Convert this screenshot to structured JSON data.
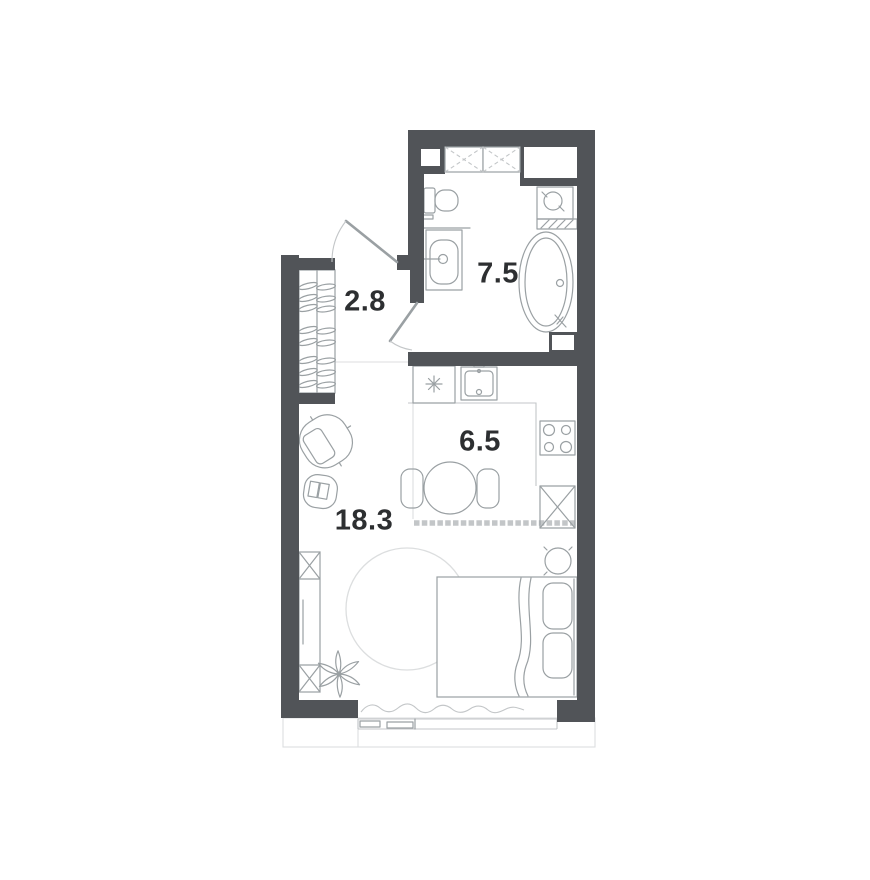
{
  "floor_plan": {
    "rooms": [
      {
        "name": "hallway",
        "area_label": "2.8"
      },
      {
        "name": "bathroom",
        "area_label": "7.5"
      },
      {
        "name": "kitchen",
        "area_label": "6.5"
      },
      {
        "name": "living-room",
        "area_label": "18.3"
      }
    ],
    "fixtures": [
      "entrance-door",
      "hallway-wardrobe-with-hangers",
      "ventilation-shaft",
      "wall-niche",
      "toilet",
      "washbasin",
      "washing-machine",
      "bathtub",
      "bathroom-door",
      "kitchen-counter",
      "dishwasher-star",
      "kitchen-sink",
      "stove",
      "refrigerator-x-cabinet",
      "dining-table",
      "dining-chairs",
      "kitchen-zone-divider",
      "armchair",
      "pouf-with-book",
      "rug",
      "wardrobe-column",
      "plant",
      "double-bed",
      "pillows",
      "nightstand",
      "curtain",
      "window",
      "balcony-sill"
    ],
    "colors": {
      "wall": "#515458",
      "fixture_line": "#9aa0a3",
      "light_line": "#c3c6c8",
      "faint_line": "#dcdedf",
      "label": "#2d2f31",
      "background": "#ffffff"
    }
  }
}
